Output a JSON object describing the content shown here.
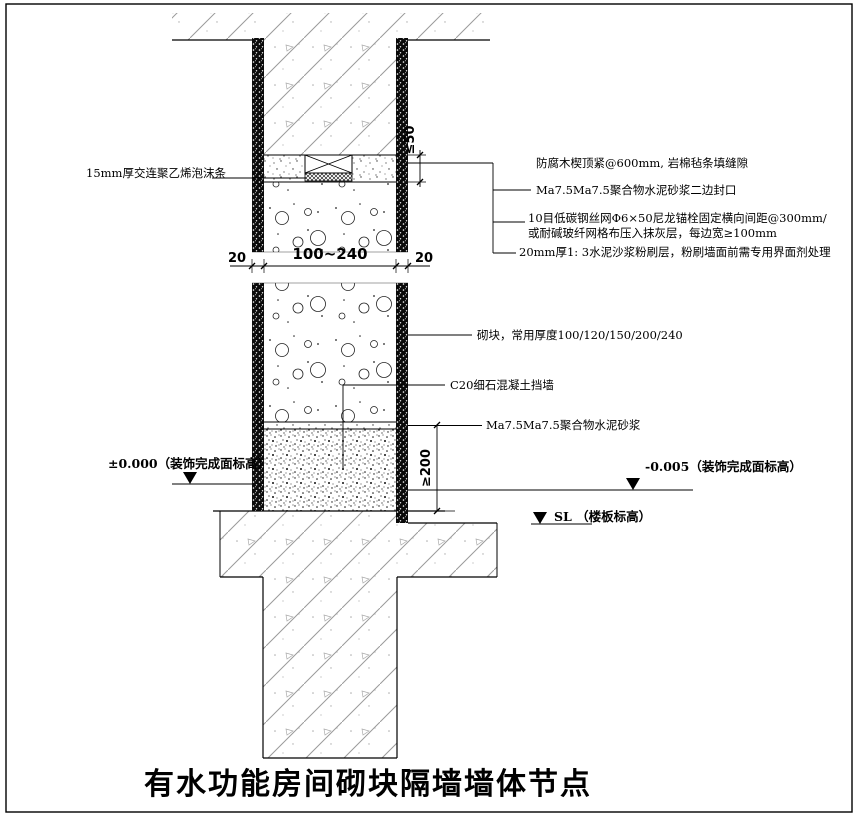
{
  "title": "有水功能房间砌块隔墙墙体节点",
  "labels": {
    "foam_strip": "15mm厚交连聚乙烯泡沫条",
    "wood_wedge": "防腐木楔顶紧@600mm, 岩棉毡条填缝隙",
    "mortar_seal": "Ma7.5Ma7.5聚合物水泥砂浆二边封口",
    "mesh_line1": "10目低碳钢丝网Φ6×50尼龙锚栓固定横向间距@300mm/",
    "mesh_line2": "或耐碱玻纤网格布压入抹灰层，每边宽≥100mm",
    "plaster_coat": "20mm厚1: 3水泥沙浆粉刷层，粉刷墙面前需专用界面剂处理",
    "block": "砌块，常用厚度100/120/150/200/240",
    "curb": "C20细石混凝土挡墙",
    "mortar_bed": "Ma7.5Ma7.5聚合物水泥砂浆",
    "level_left": "±0.000（装饰完成面标高）",
    "level_right": "-0.005（装饰完成面标高）",
    "level_slab": "SL （楼板标高）"
  },
  "dimensions": {
    "left_offset": "20",
    "wall_width": "100~240",
    "right_offset": "20",
    "joint_gap": "≤50",
    "curb_height": "≥200"
  },
  "colors": {
    "line": "#000000",
    "hatch": "#9a9a9a",
    "background": "#ffffff"
  }
}
